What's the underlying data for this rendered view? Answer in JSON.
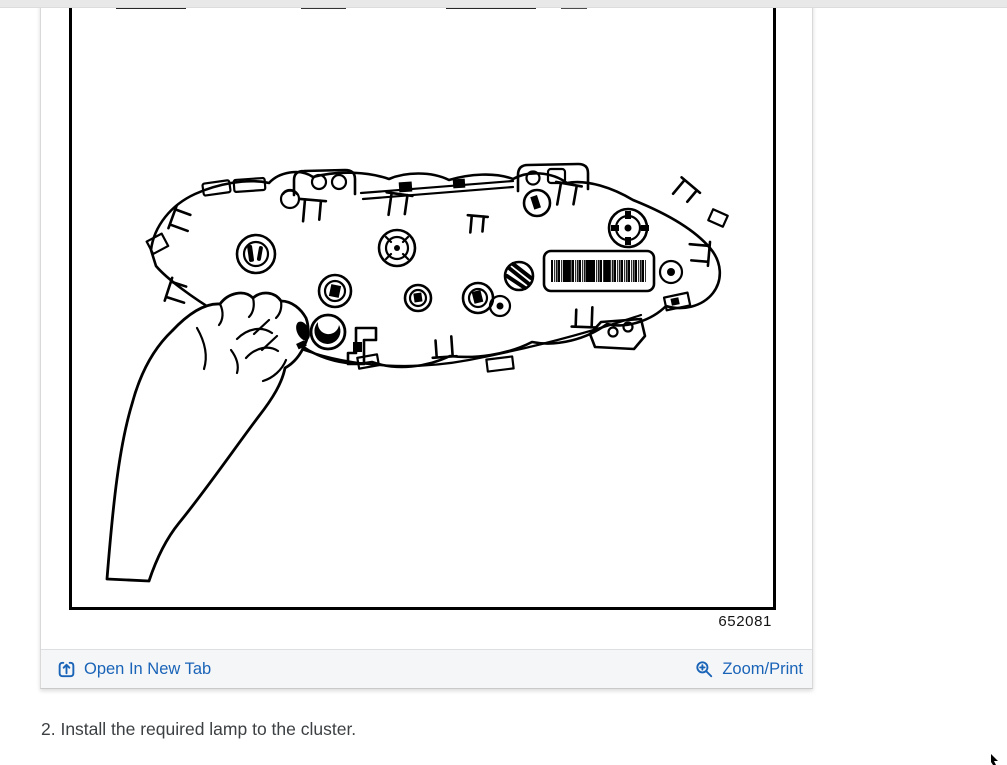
{
  "figure": {
    "id_label": "652081",
    "illustration_description": "Black-and-white line drawing of the rear of an instrument cluster showing twist-lock lamp sockets, retaining clips, a barcode label, and a hand installing a lamp into the lower-left socket",
    "toolbar": {
      "open_in_new_tab": "Open In New Tab",
      "zoom_print": "Zoom/Print"
    }
  },
  "instruction": {
    "step_text": "2. Install the required lamp to the cluster."
  },
  "colors": {
    "link": "#1a64b8",
    "toolbar_background": "#f5f6f8",
    "top_strip": "#e8e8e8",
    "body_text": "#3c4043",
    "line_art": "#000000"
  },
  "icons": {
    "open_in_new_tab": "open-in-new-tab-icon",
    "zoom_print": "magnifier-plus-icon",
    "cursor": "mouse-cursor"
  }
}
